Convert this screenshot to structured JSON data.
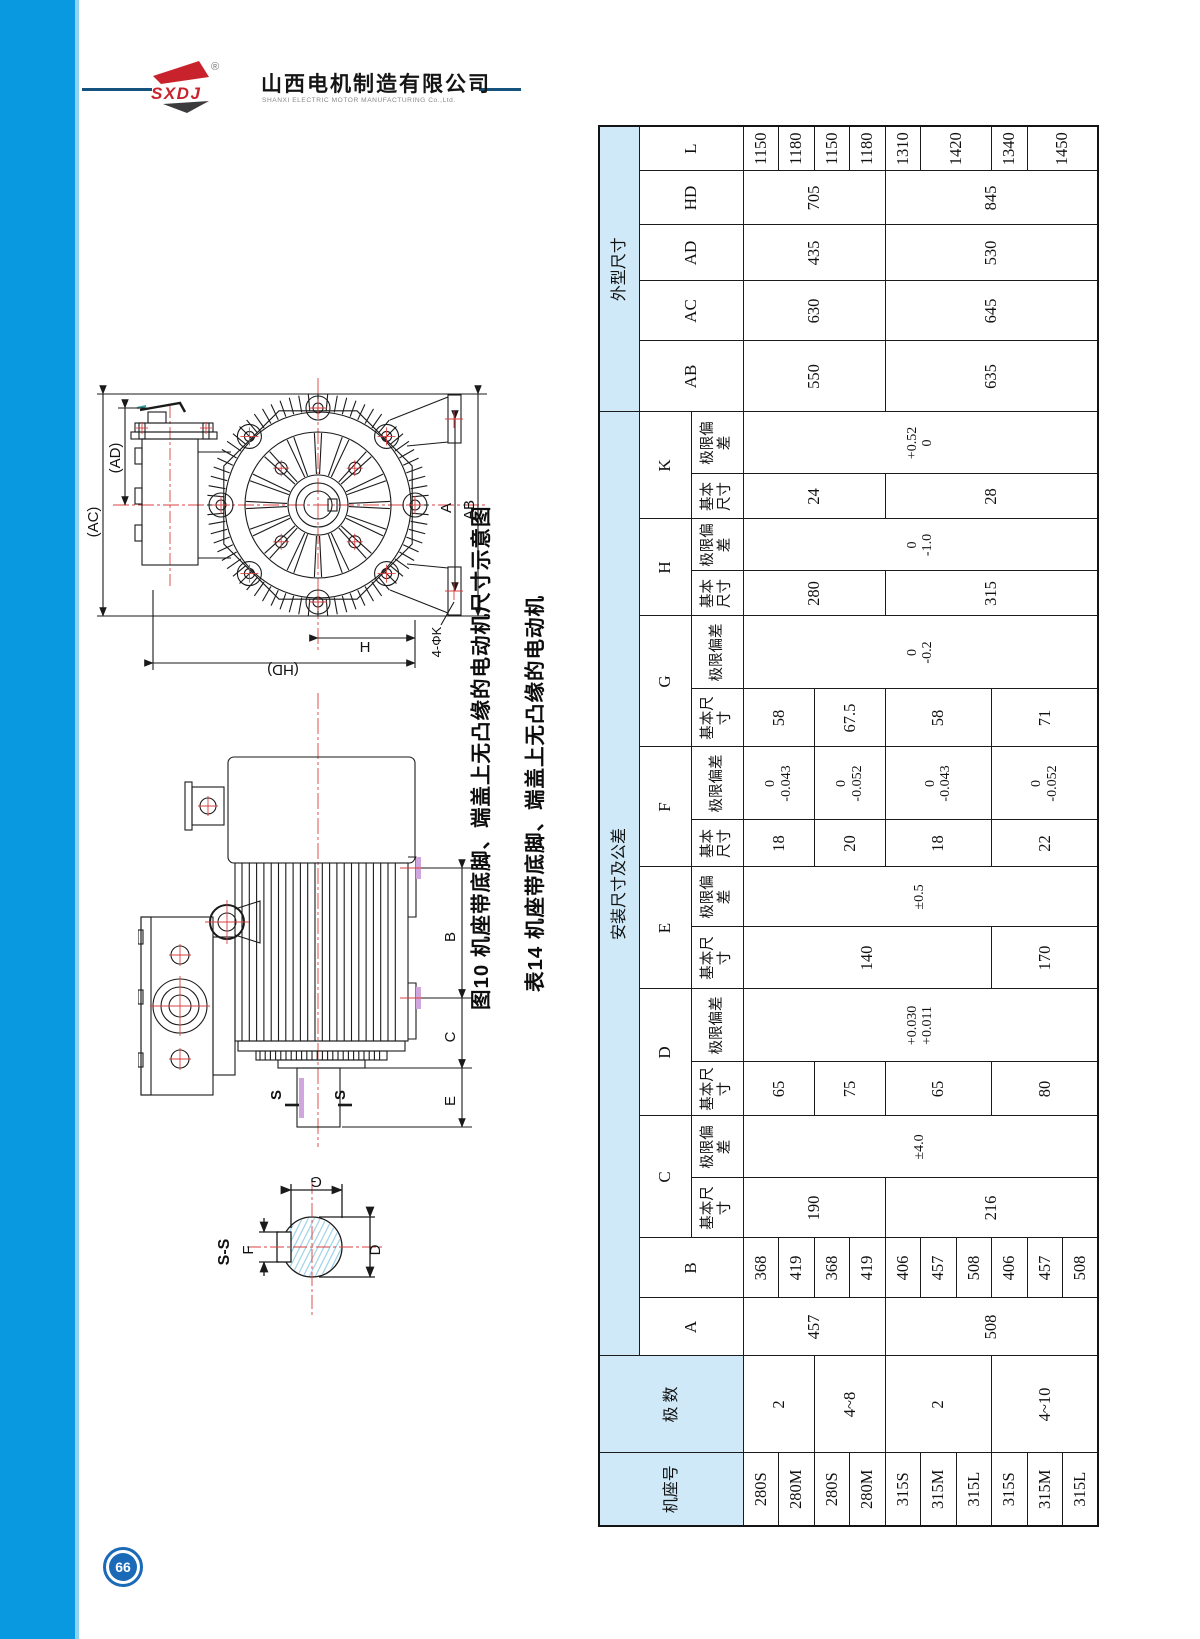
{
  "page": {
    "number": "66"
  },
  "colors": {
    "sidebar_blue": "#0899e0",
    "sidebar_edge": "#8fd3f2",
    "header_blue": "#cfe9f8",
    "logo_red": "#c8232c",
    "logo_dark": "#3b3b3d",
    "line_navy": "#16527e",
    "pagenum_blue": "#1a6ab8",
    "centerline_red": "#d84040",
    "hatch_blue": "#9fd2e8",
    "pad_violet": "#cfa6dd"
  },
  "logo": {
    "brand": "SXDJ",
    "registered": "®",
    "company_cn": "山西电机制造有限公司",
    "company_en": "SHANXI ELECTRIC MOTOR MANUFACTURING Co.,Ltd."
  },
  "captions": {
    "figure": "图10 机座带底脚、端盖上无凸缘的电动机尺寸示意图",
    "table": "表14 机座带底脚、端盖上无凸缘的电动机"
  },
  "drawings": {
    "end_view": {
      "labels": {
        "ac": "(AC)",
        "ad": "(AD)",
        "a": "A",
        "ab": "AB",
        "h": "H",
        "hd": "(HD)",
        "k": "4-ΦK"
      }
    },
    "side_view": {
      "labels": {
        "b": "B",
        "c": "C",
        "e": "E",
        "s1": "S",
        "s2": "S"
      }
    },
    "section": {
      "labels": {
        "title": "S-S",
        "g": "G",
        "d": "D",
        "f": "F"
      }
    }
  },
  "table": {
    "headers": {
      "frame": "机座号",
      "poles": "极 数",
      "mount_group": "安装尺寸及公差",
      "outline_group": "外型尺寸",
      "basic": "基本尺寸",
      "tol": "极限偏差"
    },
    "frames": [
      "280S",
      "280M",
      "280S",
      "280M",
      "315S",
      "315M",
      "315L",
      "315S",
      "315M",
      "315L"
    ],
    "poles": [
      {
        "t": "2",
        "s": 2
      },
      {
        "t": "4~8",
        "s": 2
      },
      {
        "t": "2",
        "s": 3
      },
      {
        "t": "4~10",
        "s": 3
      }
    ],
    "mount_columns": [
      {
        "letter": "A",
        "sub": false,
        "cells": [
          {
            "t": "457",
            "s": 4
          },
          {
            "t": "508",
            "s": 6
          }
        ]
      },
      {
        "letter": "B",
        "sub": false,
        "cells": [
          {
            "t": "368",
            "s": 1
          },
          {
            "t": "419",
            "s": 1
          },
          {
            "t": "368",
            "s": 1
          },
          {
            "t": "419",
            "s": 1
          },
          {
            "t": "406",
            "s": 1
          },
          {
            "t": "457",
            "s": 1
          },
          {
            "t": "508",
            "s": 1
          },
          {
            "t": "406",
            "s": 1
          },
          {
            "t": "457",
            "s": 1
          },
          {
            "t": "508",
            "s": 1
          }
        ]
      },
      {
        "letter": "C",
        "sub": true,
        "basic": [
          {
            "t": "190",
            "s": 4
          },
          {
            "t": "216",
            "s": 6
          }
        ],
        "tol": [
          {
            "t": [
              "±4.0"
            ],
            "s": 10
          }
        ]
      },
      {
        "letter": "D",
        "sub": true,
        "basic": [
          {
            "t": "65",
            "s": 2
          },
          {
            "t": "75",
            "s": 2
          },
          {
            "t": "65",
            "s": 3
          },
          {
            "t": "80",
            "s": 3
          }
        ],
        "tol": [
          {
            "t": [
              "+0.030",
              "+0.011"
            ],
            "s": 10
          }
        ]
      },
      {
        "letter": "E",
        "sub": true,
        "basic": [
          {
            "t": "140",
            "s": 7
          },
          {
            "t": "170",
            "s": 3
          }
        ],
        "tol": [
          {
            "t": [
              "±0.5"
            ],
            "s": 10
          }
        ]
      },
      {
        "letter": "F",
        "sub": true,
        "basic": [
          {
            "t": "18",
            "s": 2
          },
          {
            "t": "20",
            "s": 2
          },
          {
            "t": "18",
            "s": 3
          },
          {
            "t": "22",
            "s": 3
          }
        ],
        "tol": [
          {
            "t": [
              "0",
              "-0.043"
            ],
            "s": 2
          },
          {
            "t": [
              "0",
              "-0.052"
            ],
            "s": 2
          },
          {
            "t": [
              "0",
              "-0.043"
            ],
            "s": 3
          },
          {
            "t": [
              "0",
              "-0.052"
            ],
            "s": 3
          }
        ]
      },
      {
        "letter": "G",
        "sub": true,
        "basic": [
          {
            "t": "58",
            "s": 2
          },
          {
            "t": "67.5",
            "s": 2
          },
          {
            "t": "58",
            "s": 3
          },
          {
            "t": "71",
            "s": 3
          }
        ],
        "tol": [
          {
            "t": [
              "0",
              "-0.2"
            ],
            "s": 10
          }
        ]
      },
      {
        "letter": "H",
        "sub": true,
        "basic": [
          {
            "t": "280",
            "s": 4
          },
          {
            "t": "315",
            "s": 6
          }
        ],
        "tol": [
          {
            "t": [
              "0",
              "-1.0"
            ],
            "s": 10
          }
        ]
      },
      {
        "letter": "K",
        "sub": true,
        "basic": [
          {
            "t": "24",
            "s": 4
          },
          {
            "t": "28",
            "s": 6
          }
        ],
        "tol": [
          {
            "t": [
              "+0.52",
              "0"
            ],
            "s": 10
          }
        ]
      }
    ],
    "outline_columns": [
      {
        "letter": "AB",
        "cells": [
          {
            "t": "550",
            "s": 4
          },
          {
            "t": "635",
            "s": 6
          }
        ]
      },
      {
        "letter": "AC",
        "cells": [
          {
            "t": "630",
            "s": 4
          },
          {
            "t": "645",
            "s": 6
          }
        ]
      },
      {
        "letter": "AD",
        "cells": [
          {
            "t": "435",
            "s": 4
          },
          {
            "t": "530",
            "s": 6
          }
        ]
      },
      {
        "letter": "HD",
        "cells": [
          {
            "t": "705",
            "s": 4
          },
          {
            "t": "845",
            "s": 6
          }
        ]
      },
      {
        "letter": "L",
        "cells": [
          {
            "t": "1150",
            "s": 1
          },
          {
            "t": "1180",
            "s": 1
          },
          {
            "t": "1150",
            "s": 1
          },
          {
            "t": "1180",
            "s": 1
          },
          {
            "t": "1310",
            "s": 1
          },
          {
            "t": "1420",
            "s": 2
          },
          {
            "t": "1340",
            "s": 1
          },
          {
            "t": "1450",
            "s": 2
          }
        ]
      }
    ]
  }
}
